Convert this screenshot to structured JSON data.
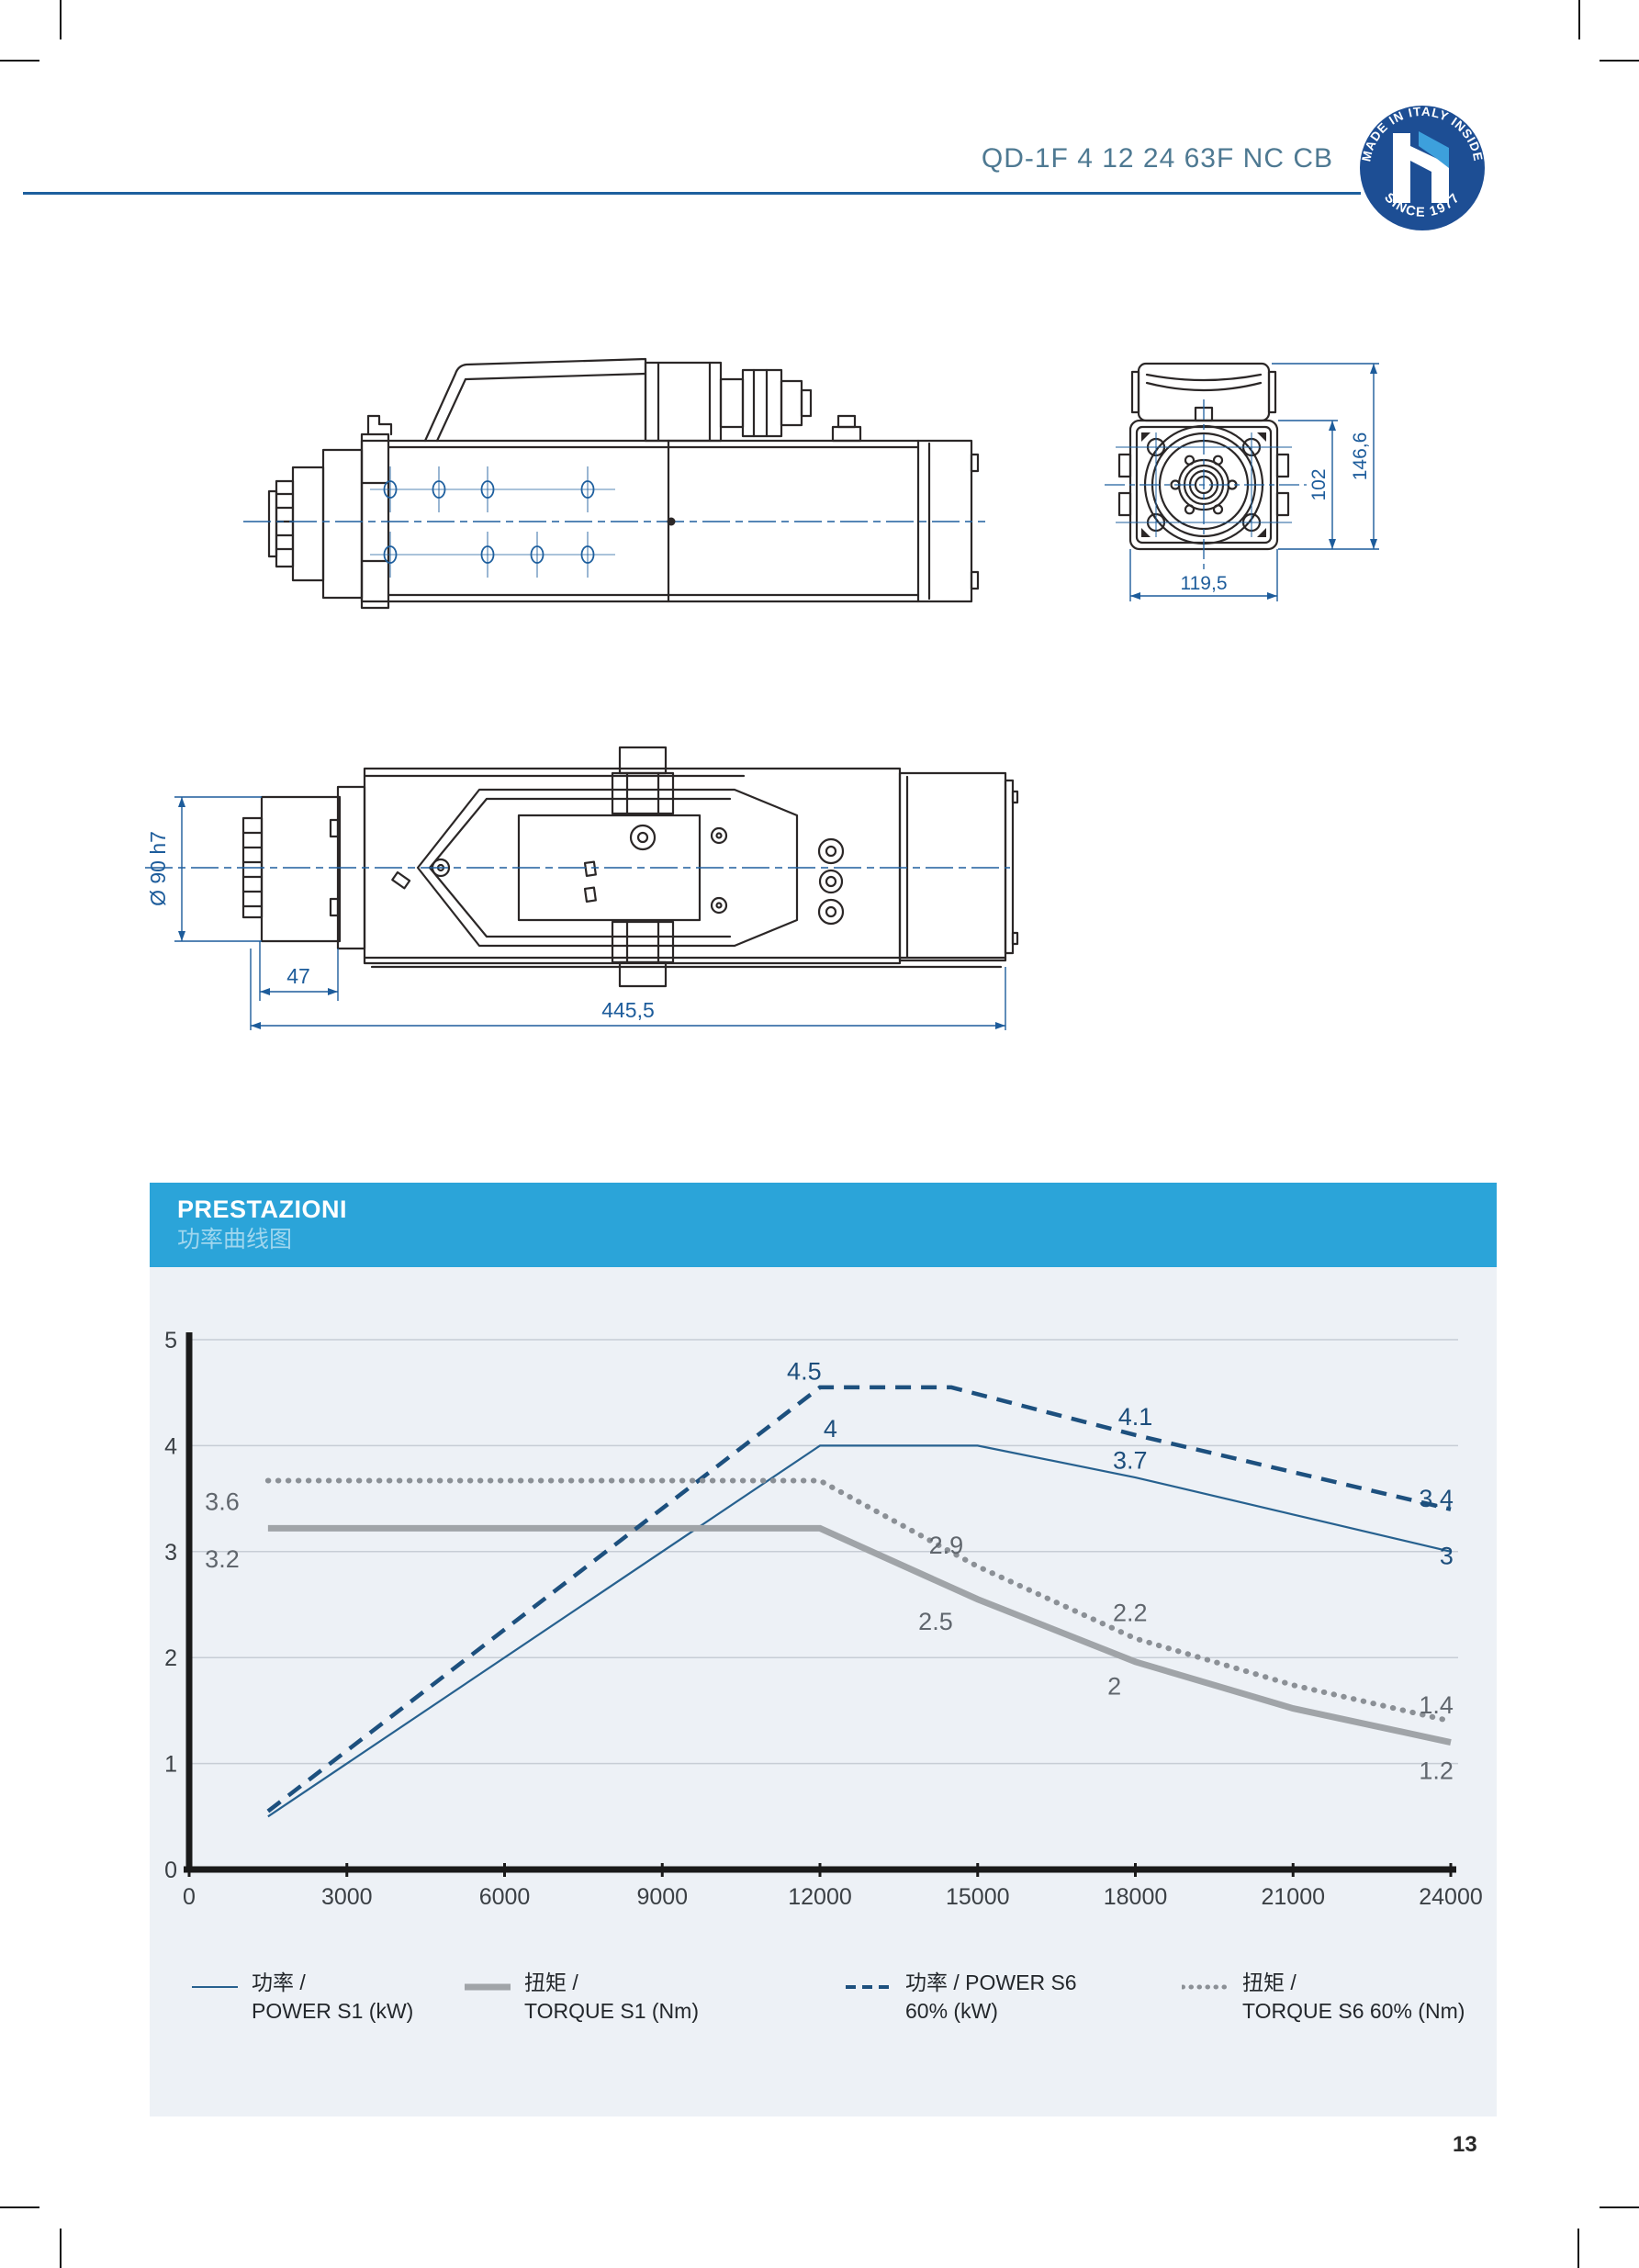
{
  "header": {
    "model": "QD-1F 4 12 24 63F NC CB",
    "badge": {
      "ring_top": "MADE IN ITALY INSIDE",
      "ring_bottom": "SINCE 1977",
      "letter": "h",
      "circle_color": "#1d4e94",
      "flag_color": "#3da0dc"
    }
  },
  "drawings": {
    "front_view": {
      "dim_height_total": "146,6",
      "dim_height_body": "102",
      "dim_width": "119,5"
    },
    "top_view": {
      "dim_diameter": "Ø 90 h7",
      "dim_nose": "47",
      "dim_length": "445,5"
    }
  },
  "panel": {
    "title": "PRESTAZIONI",
    "subtitle": "功率曲线图"
  },
  "chart_data": {
    "type": "line",
    "title": "PRESTAZIONI / 功率曲线图",
    "xlabel": "",
    "ylabel": "",
    "xlim": [
      0,
      24000
    ],
    "ylim": [
      0,
      5
    ],
    "x_ticks": [
      0,
      3000,
      6000,
      9000,
      12000,
      15000,
      18000,
      21000,
      24000
    ],
    "y_ticks": [
      0,
      1,
      2,
      3,
      4,
      5
    ],
    "grid": "horizontal",
    "legend_position": "bottom",
    "series": [
      {
        "name": "POWER S1 (kW)",
        "style": "solid-thin",
        "color": "#27618f",
        "points": [
          [
            1500,
            0.5
          ],
          [
            12000,
            4
          ],
          [
            15000,
            4
          ],
          [
            18000,
            3.7
          ],
          [
            21000,
            3.35
          ],
          [
            24000,
            3
          ]
        ]
      },
      {
        "name": "TORQUE S1 (Nm)",
        "style": "solid-thick",
        "color": "#a0a4a8",
        "points": [
          [
            1500,
            3.22
          ],
          [
            12000,
            3.22
          ],
          [
            15000,
            2.55
          ],
          [
            18000,
            1.96
          ],
          [
            21000,
            1.52
          ],
          [
            24000,
            1.2
          ]
        ]
      },
      {
        "name": "POWER S6 60% (kW)",
        "style": "dashed",
        "color": "#1d507e",
        "points": [
          [
            1500,
            0.55
          ],
          [
            12000,
            4.55
          ],
          [
            14500,
            4.55
          ],
          [
            18000,
            4.1
          ],
          [
            21000,
            3.75
          ],
          [
            24000,
            3.4
          ]
        ]
      },
      {
        "name": "TORQUE S6 60% (Nm)",
        "style": "dotted",
        "color": "#8b9096",
        "points": [
          [
            1500,
            3.67
          ],
          [
            12000,
            3.67
          ],
          [
            15000,
            2.86
          ],
          [
            18000,
            2.18
          ],
          [
            21000,
            1.74
          ],
          [
            24000,
            1.4
          ]
        ]
      }
    ],
    "annotations": [
      {
        "text": "4.5",
        "x": 11700,
        "y": 4.7,
        "cls": "power"
      },
      {
        "text": "4",
        "x": 12200,
        "y": 4.16,
        "cls": "power"
      },
      {
        "text": "4.1",
        "x": 18000,
        "y": 4.27,
        "cls": "power"
      },
      {
        "text": "3.7",
        "x": 17900,
        "y": 3.86,
        "cls": "power"
      },
      {
        "text": "3.4",
        "x": 24050,
        "y": 3.5,
        "cls": "power",
        "anchor": "end"
      },
      {
        "text": "3",
        "x": 24050,
        "y": 2.96,
        "cls": "power",
        "anchor": "end"
      },
      {
        "text": "3.6",
        "x": 300,
        "y": 3.47,
        "cls": "torque",
        "anchor": "start"
      },
      {
        "text": "3.2",
        "x": 300,
        "y": 2.93,
        "cls": "torque",
        "anchor": "start"
      },
      {
        "text": "2.9",
        "x": 14400,
        "y": 3.06,
        "cls": "torque"
      },
      {
        "text": "2.5",
        "x": 14200,
        "y": 2.34,
        "cls": "torque"
      },
      {
        "text": "2.2",
        "x": 17900,
        "y": 2.42,
        "cls": "torque"
      },
      {
        "text": "2",
        "x": 17600,
        "y": 1.73,
        "cls": "torque"
      },
      {
        "text": "1.4",
        "x": 24050,
        "y": 1.55,
        "cls": "torque",
        "anchor": "end"
      },
      {
        "text": "1.2",
        "x": 24050,
        "y": 0.93,
        "cls": "torque",
        "anchor": "end"
      }
    ]
  },
  "legend": [
    {
      "line1": "功率 /",
      "line2": "POWER S1 (kW)",
      "style": "solid-thin"
    },
    {
      "line1": "扭矩 /",
      "line2": "TORQUE S1 (Nm)",
      "style": "solid-thick"
    },
    {
      "line1": "功率 / POWER S6",
      "line2": "60% (kW)",
      "style": "dashed"
    },
    {
      "line1": "扭矩 /",
      "line2": "TORQUE S6 60% (Nm)",
      "style": "dotted"
    }
  ],
  "page_number": "13"
}
